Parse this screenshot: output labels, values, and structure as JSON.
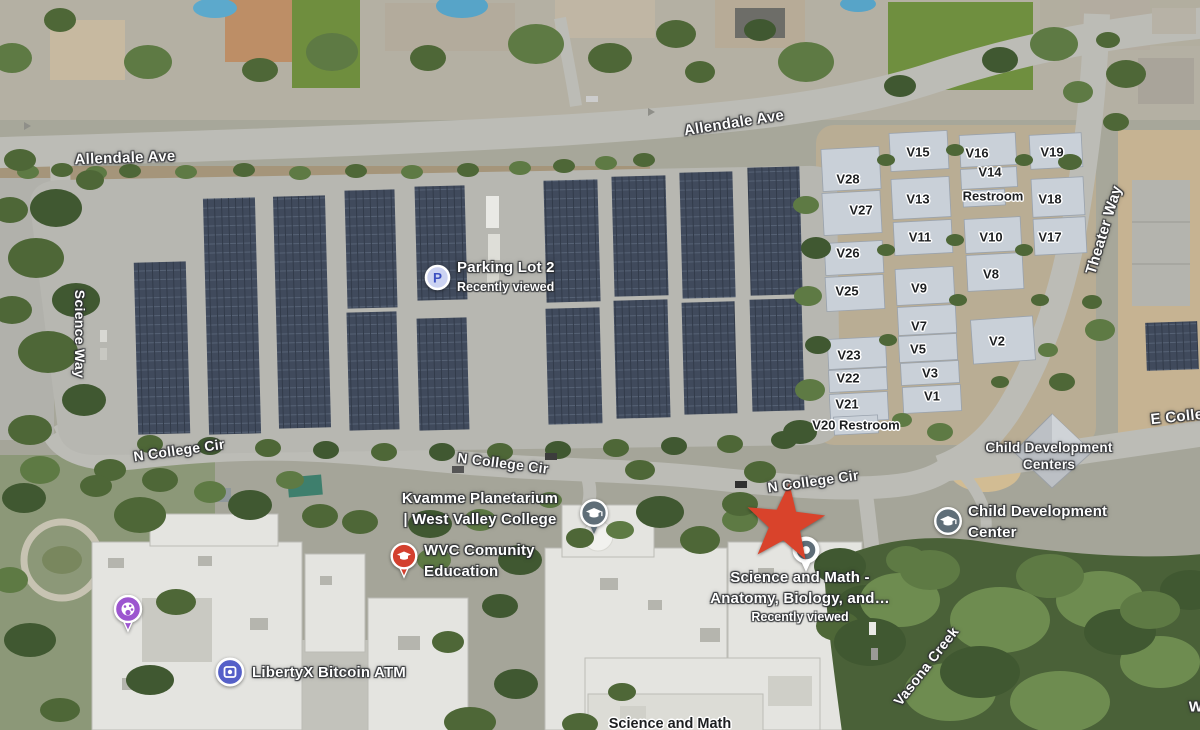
{
  "map": {
    "road_labels": [
      {
        "text": "Allendale Ave",
        "x": 125,
        "y": 158,
        "rot": -2,
        "size": 15
      },
      {
        "text": "Allendale Ave",
        "x": 734,
        "y": 123,
        "rot": -9,
        "size": 15
      },
      {
        "text": "Science Way",
        "x": 80,
        "y": 334,
        "rot": 90,
        "size": 14
      },
      {
        "text": "N College Cir",
        "x": 179,
        "y": 450,
        "rot": -8,
        "size": 14
      },
      {
        "text": "N College Cir",
        "x": 503,
        "y": 463,
        "rot": 7,
        "size": 14
      },
      {
        "text": "N College Cir",
        "x": 813,
        "y": 481,
        "rot": -8,
        "size": 14
      },
      {
        "text": "Theater Way",
        "x": 1104,
        "y": 230,
        "rot": -73,
        "size": 15
      },
      {
        "text": "E Colle",
        "x": 1177,
        "y": 417,
        "rot": -6,
        "size": 15
      },
      {
        "text": "W",
        "x": 1196,
        "y": 707,
        "rot": 0,
        "size": 15
      }
    ],
    "building_labels": [
      {
        "text": "V15",
        "x": 918,
        "y": 152
      },
      {
        "text": "V16",
        "x": 977,
        "y": 153
      },
      {
        "text": "V19",
        "x": 1052,
        "y": 152
      },
      {
        "text": "V28",
        "x": 848,
        "y": 179
      },
      {
        "text": "V14",
        "x": 990,
        "y": 172
      },
      {
        "text": "Restroom",
        "x": 993,
        "y": 196
      },
      {
        "text": "V13",
        "x": 918,
        "y": 199
      },
      {
        "text": "V27",
        "x": 861,
        "y": 210
      },
      {
        "text": "V18",
        "x": 1050,
        "y": 199
      },
      {
        "text": "V26",
        "x": 848,
        "y": 253
      },
      {
        "text": "V11",
        "x": 920,
        "y": 237
      },
      {
        "text": "V10",
        "x": 991,
        "y": 237
      },
      {
        "text": "V17",
        "x": 1050,
        "y": 237
      },
      {
        "text": "V25",
        "x": 847,
        "y": 291
      },
      {
        "text": "V9",
        "x": 919,
        "y": 288
      },
      {
        "text": "V8",
        "x": 991,
        "y": 274
      },
      {
        "text": "V7",
        "x": 919,
        "y": 326
      },
      {
        "text": "V5",
        "x": 918,
        "y": 349
      },
      {
        "text": "V2",
        "x": 997,
        "y": 341
      },
      {
        "text": "V23",
        "x": 849,
        "y": 355
      },
      {
        "text": "V3",
        "x": 930,
        "y": 373
      },
      {
        "text": "V22",
        "x": 848,
        "y": 378
      },
      {
        "text": "V1",
        "x": 932,
        "y": 396
      },
      {
        "text": "V21",
        "x": 847,
        "y": 404
      },
      {
        "text": "V20 Restroom",
        "x": 856,
        "y": 425
      },
      {
        "text": "Science and Math",
        "x": 670,
        "y": 724,
        "size": 14.5
      }
    ],
    "area_labels": [
      {
        "lines": [
          "Child Development",
          "Centers"
        ],
        "x": 1049,
        "y": 456
      }
    ],
    "water_labels": [
      {
        "text": "Vasona Creek",
        "x": 926,
        "y": 666,
        "rot": -52,
        "size": 14
      }
    ],
    "places": {
      "parking_lot2": {
        "icon_letter": "P",
        "name": "Parking Lot 2",
        "status": "Recently viewed"
      },
      "kvamme_planetarium": {
        "line1": "Kvamme Planetarium",
        "line2": "| West Valley College"
      },
      "wvc_community_education": {
        "line1": "WVC Comunity",
        "line2": "Education"
      },
      "libertyx_bitcoin_atm": {
        "name": "LibertyX Bitcoin ATM"
      },
      "science_and_math": {
        "line1": "Science and Math -",
        "line2": "Anatomy, Biology, and…",
        "status": "Recently viewed"
      },
      "child_development_center": {
        "line1": "Child Development",
        "line2": "Center"
      }
    },
    "colors": {
      "marker_red": "#d9432b",
      "parking_blue": "#3b4fc0",
      "pin_red": "#d3402f",
      "pin_purple": "#9c55cf",
      "pin_slate": "#5f6e78",
      "pin_indigo": "#5560c8"
    }
  }
}
